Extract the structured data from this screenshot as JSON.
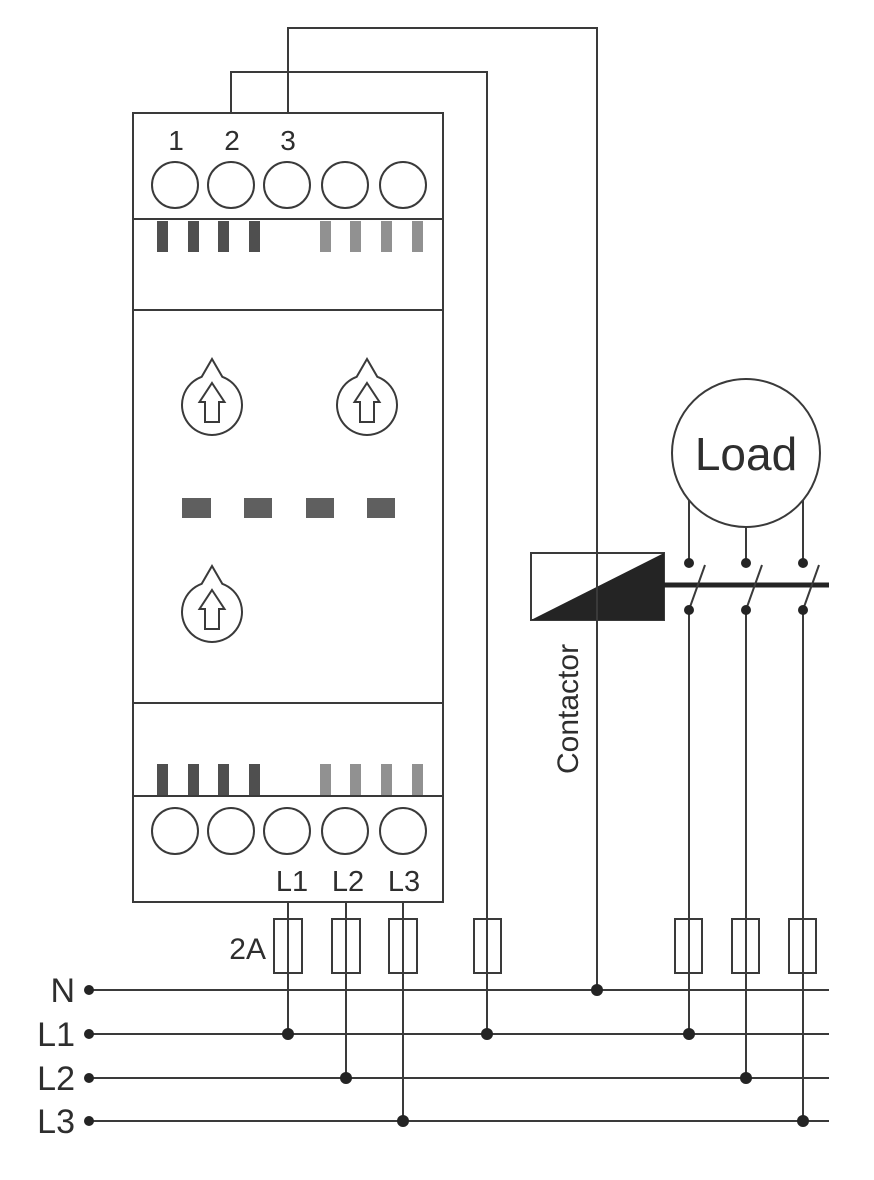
{
  "figure_type": "electrical-wiring-diagram",
  "colors": {
    "line": "#3a3a3a",
    "ink": "#2e2e2e",
    "fill_black": "#242424",
    "tick_dark": "#4f4f4f",
    "tick_light": "#919191",
    "segment_dash": "#5f5f5f",
    "background": "#ffffff"
  },
  "device": {
    "top_terminals": [
      "1",
      "2",
      "3"
    ],
    "bottom_terminals": [
      "L1",
      "L2",
      "L3"
    ],
    "knob_count": 3,
    "display_segment_count": 4
  },
  "fuse": {
    "rating_label": "2A",
    "count": 7
  },
  "bus": {
    "labels": [
      "N",
      "L1",
      "L2",
      "L3"
    ]
  },
  "contactor": {
    "label": "Contactor"
  },
  "load": {
    "label": "Load"
  }
}
